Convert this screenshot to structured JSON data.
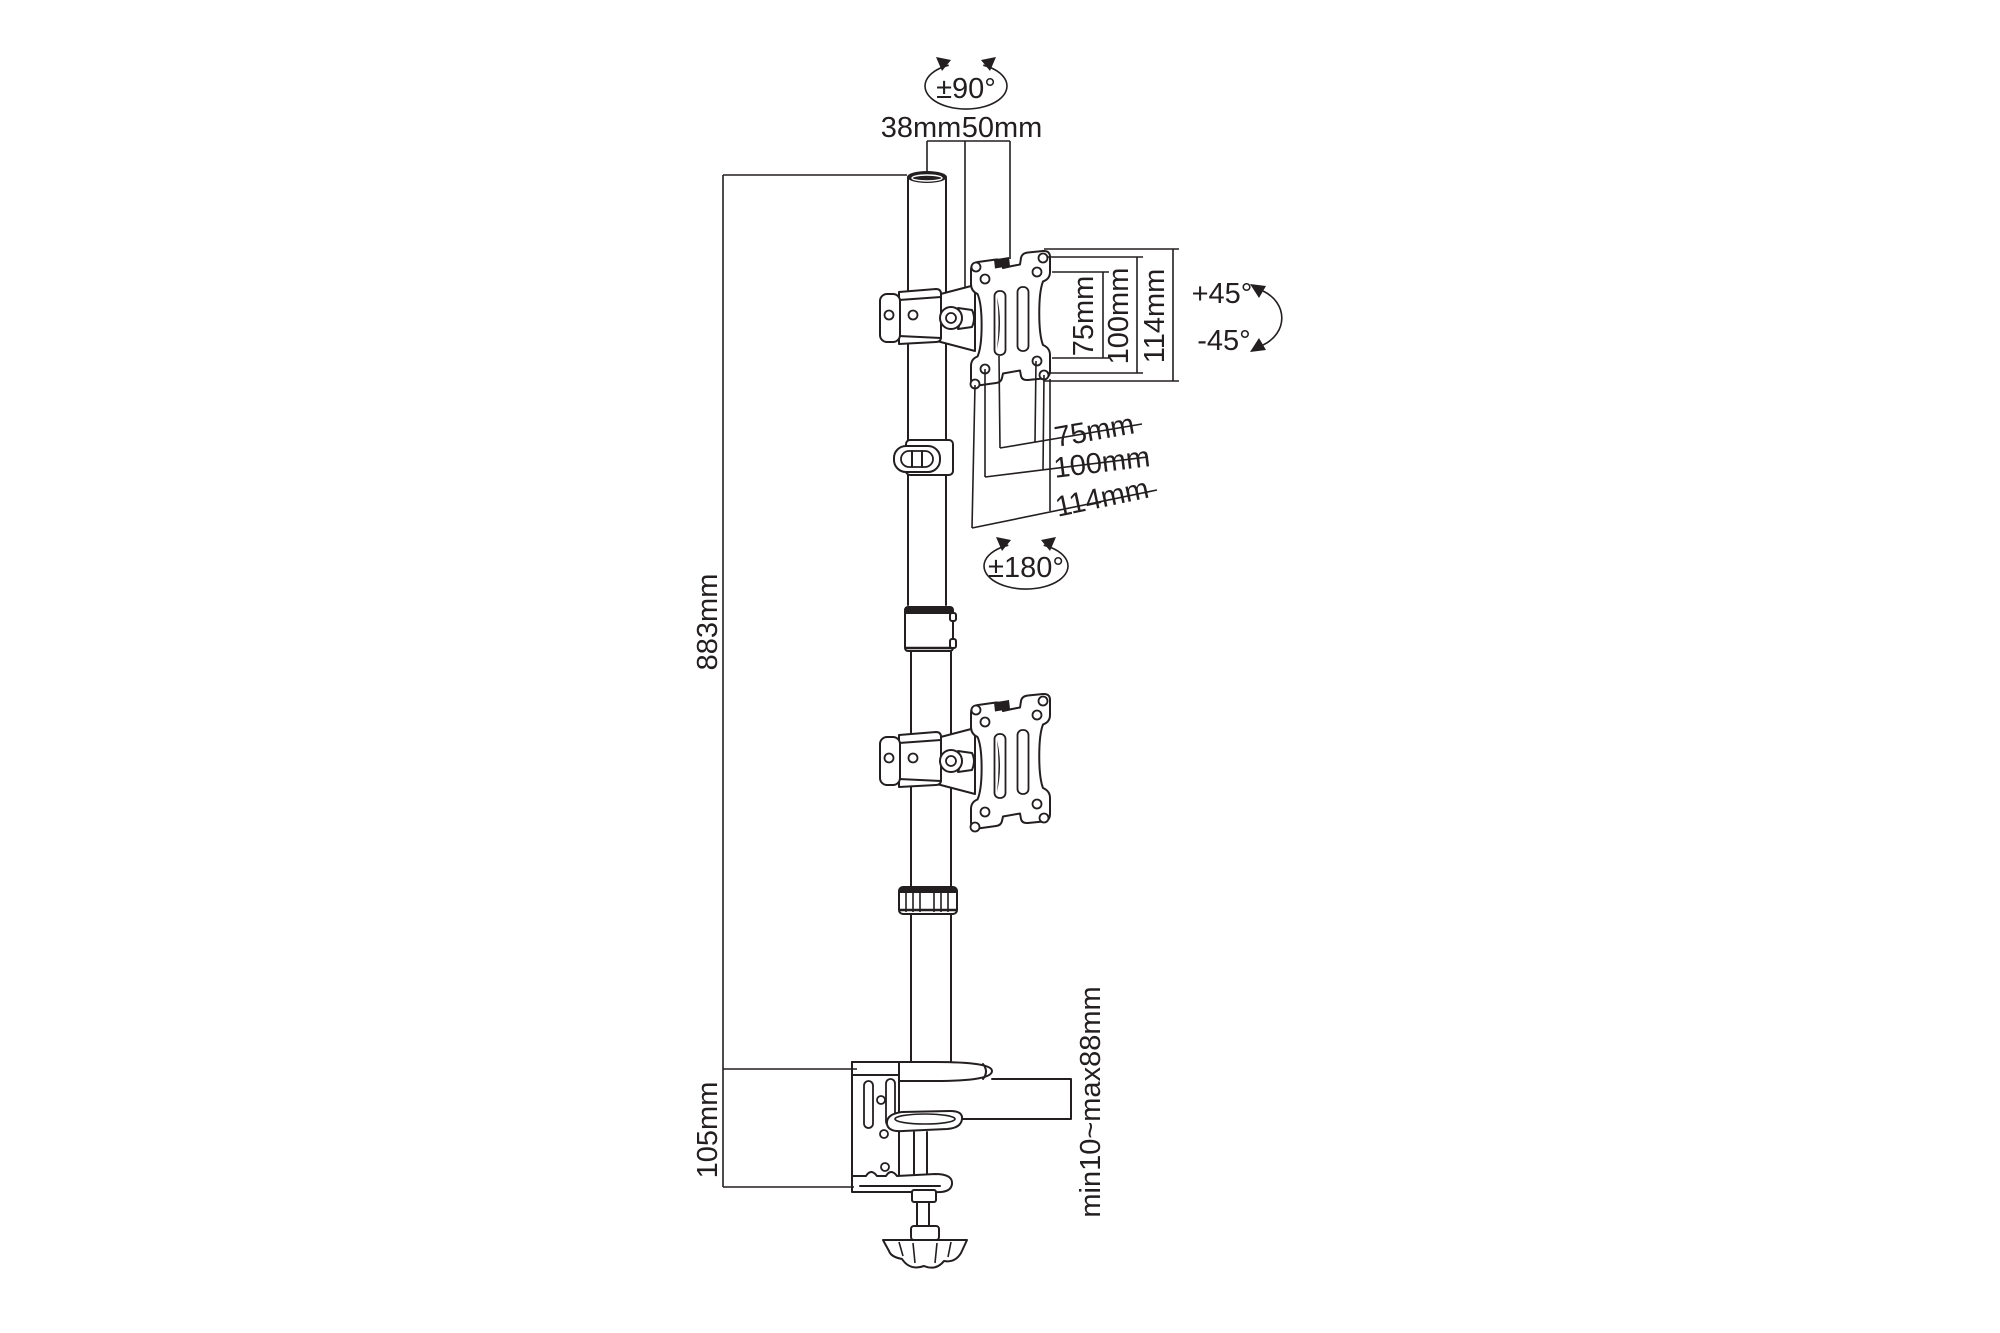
{
  "canvas": {
    "width": 2000,
    "height": 1333,
    "background": "#ffffff",
    "line_color": "#231f20"
  },
  "diagram": {
    "subject": "vertical dual-monitor desk mount pole - dimension drawing",
    "labels": {
      "top_rotation": "±90°",
      "pole_width": "38mm",
      "pole_offset": "50mm",
      "vesa_v_75": "75mm",
      "vesa_v_100": "100mm",
      "vesa_v_114": "114mm",
      "tilt_up": "+45°",
      "tilt_down": "-45°",
      "vesa_h_75": "75mm",
      "vesa_h_100": "100mm",
      "vesa_h_114": "114mm",
      "mid_rotation": "±180°",
      "pole_height": "883mm",
      "bracket_height": "105mm",
      "desk_thickness": "min10~max88mm"
    }
  }
}
